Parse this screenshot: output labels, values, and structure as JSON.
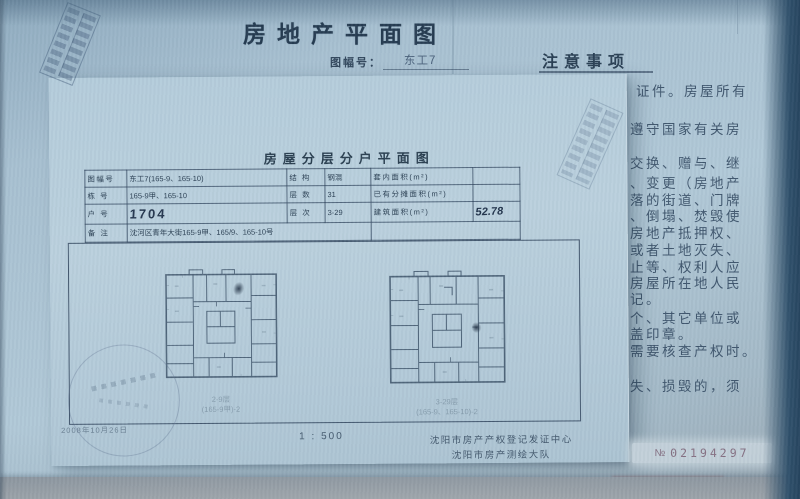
{
  "under_doc": {
    "title": "房地产平面图",
    "sheet_label": "图幅号：",
    "sheet_value": "东工7",
    "notice_title": "注意事项",
    "notice_lines": [
      "证件。房屋所有",
      "遵守国家有关房",
      "交换、赠与、继",
      "、变更（房地产",
      "落的街道、门牌",
      "、倒塌、焚毁使",
      "房地产抵押权、",
      "或者土地灭失、",
      "止等、权利人应",
      "房屋所在地人民",
      "记。",
      "个、其它单位或",
      "盖印章。",
      "需要核查产权时。",
      "失、损毁的，须"
    ],
    "serial_prefix": "№",
    "serial_number": "02194297"
  },
  "over_doc": {
    "title": "房屋分层分户平面图",
    "table": {
      "rows": [
        {
          "c1": "图幅号",
          "c2": "东工7(165-9、165-10)",
          "c3": "结 构",
          "c4": "钢混",
          "c5": "套内面积(m²)",
          "c6": ""
        },
        {
          "c1": "栋 号",
          "c2": "165-9甲、165-10",
          "c3": "层 数",
          "c4": "31",
          "c5": "已有分摊面积(m²)",
          "c6": ""
        },
        {
          "c1": "户 号",
          "c2": "1704",
          "c3": "层 次",
          "c4": "3-29",
          "c5": "建筑面积(m²)",
          "c6": "52.78"
        },
        {
          "c1": "备 注",
          "c2": "沈河区青年大街165-9甲、165/9、165-10号",
          "c3": ""
        }
      ]
    },
    "plans": [
      {
        "caption_line1": "2-9层",
        "caption_line2": "(165-9甲)-2"
      },
      {
        "caption_line1": "3-29层",
        "caption_line2": "(165-9、165-10)-2"
      }
    ],
    "scale": "1 : 500",
    "agency_line1": "沈阳市房产产权登记发证中心",
    "agency_line2": "沈阳市房产测绘大队",
    "date": "2008年10月26日"
  },
  "colors": {
    "paper": "#aec6d6",
    "overlay_paper": "#b6cddb",
    "ink": "#2e4256",
    "serial_text": "#857083"
  }
}
